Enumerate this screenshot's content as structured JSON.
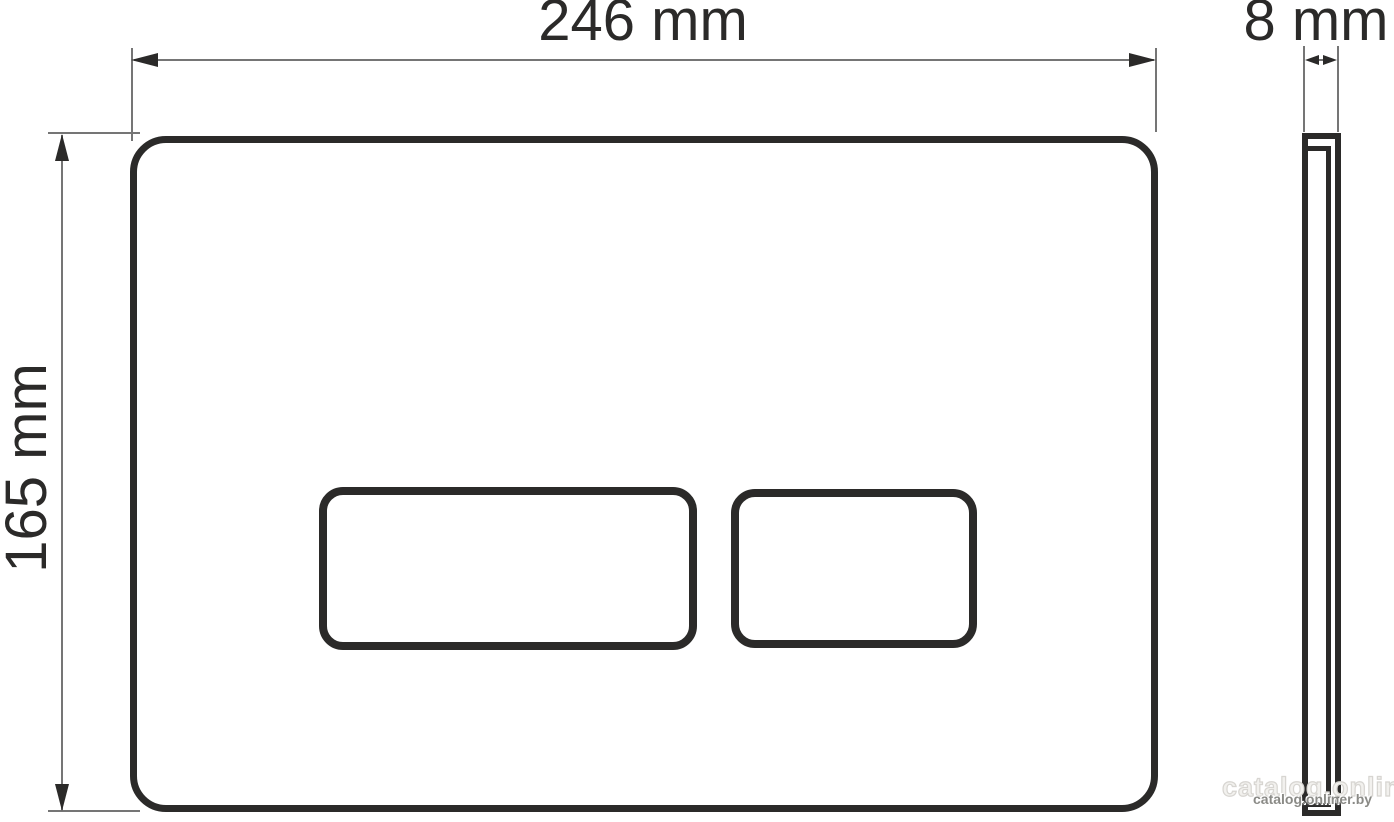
{
  "drawing": {
    "width_label": "246 mm",
    "depth_label": "8 mm",
    "height_label": "165 mm"
  },
  "watermark": {
    "text": "catalog.onliner.by"
  },
  "colors": {
    "outline": "#2b2a29",
    "dimension_line": "#757575",
    "watermark_text": "#8a8a86",
    "background": "#ffffff"
  }
}
